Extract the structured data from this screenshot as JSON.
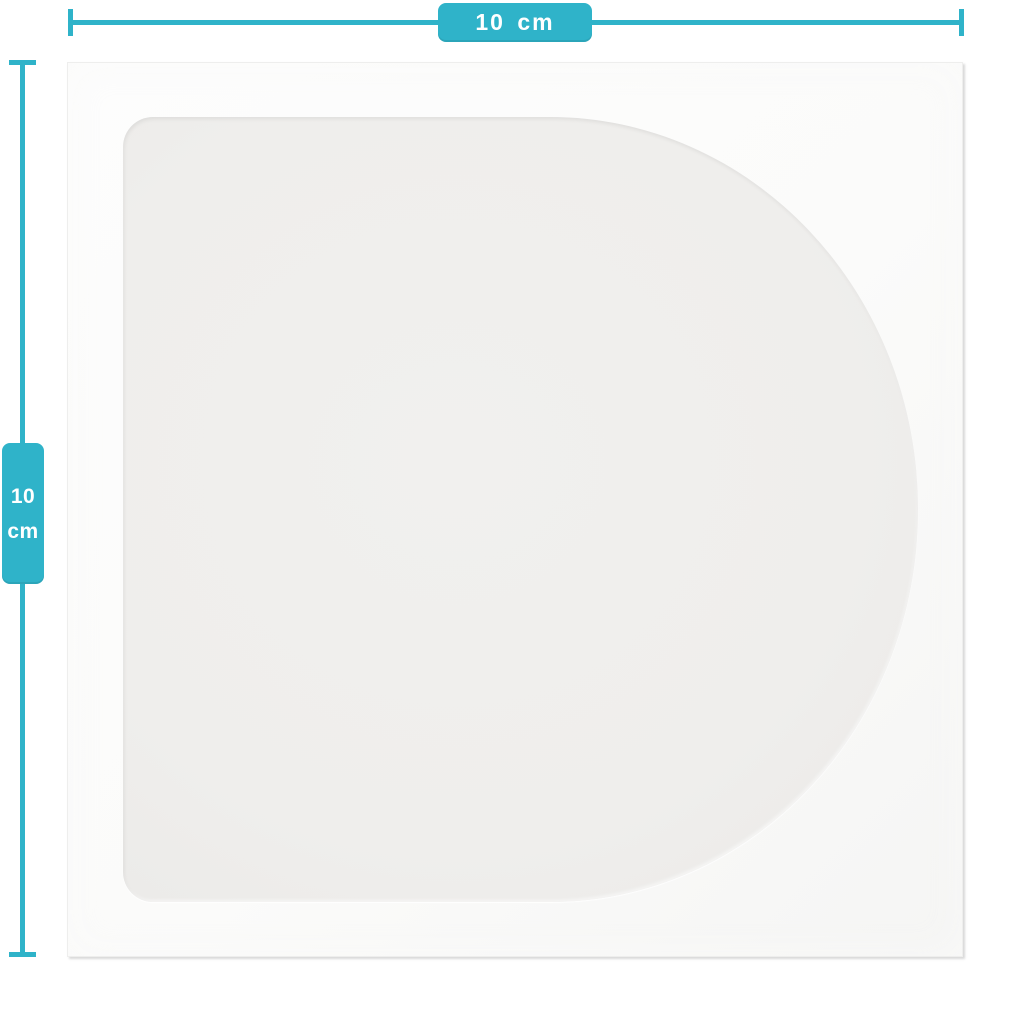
{
  "diagram": {
    "width_dimension": {
      "label": "10 cm"
    },
    "height_dimension": {
      "value": "10",
      "unit": "cm"
    }
  },
  "colors": {
    "accent": "#2fb3c9",
    "badge_text": "#ffffff",
    "sleeve": "#fbfbfa",
    "sleeve_edge": "#d6d6d5",
    "window": "#efeeec",
    "background": "#ffffff"
  }
}
